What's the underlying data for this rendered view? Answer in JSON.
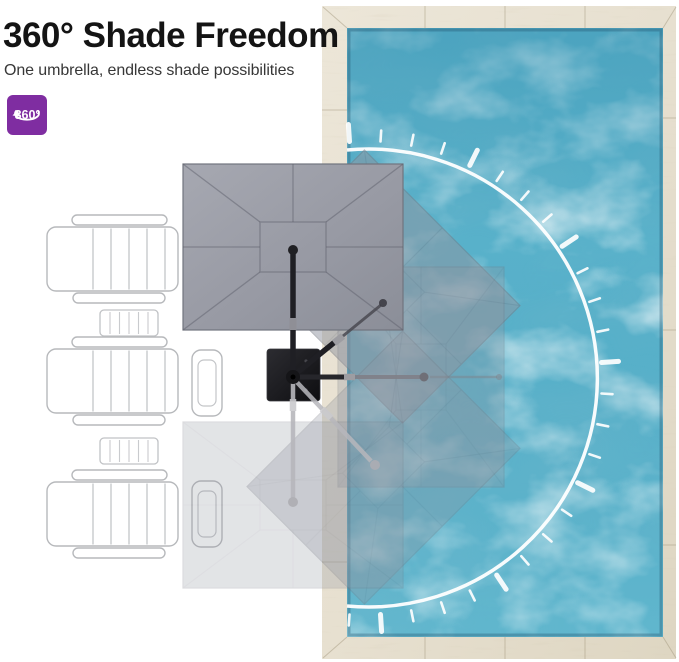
{
  "header": {
    "title": "360° Shade Freedom",
    "subtitle": "One umbrella, endless shade possibilities",
    "badge": {
      "label": "360°",
      "icon": "rotation-360-icon"
    }
  },
  "colors": {
    "accent_purple": "#7f2da1",
    "pool_water": "#58b1ca",
    "deck_beige": "#e9e3d5",
    "canopy_gray": "#9095a0",
    "pole_black": "#1f1f24",
    "arc_white": "#ffffff"
  },
  "scene": {
    "description": "Top-down patio plan: pool with wood deck, three lounge chairs with side tables, cantilever umbrella on a square base shown in five rotated shade positions",
    "umbrella_positions": [
      {
        "angle_deg": 0,
        "opacity": 1.0
      },
      {
        "angle_deg": 45,
        "opacity": 0.5
      },
      {
        "angle_deg": 90,
        "opacity": 0.3
      },
      {
        "angle_deg": 135,
        "opacity": 0.3
      },
      {
        "angle_deg": 180,
        "opacity": 0.25
      }
    ],
    "rotation_arc": {
      "ticks": 26,
      "start_deg": -93.75,
      "step_deg": 7.5,
      "big_tick_every": 4
    }
  }
}
